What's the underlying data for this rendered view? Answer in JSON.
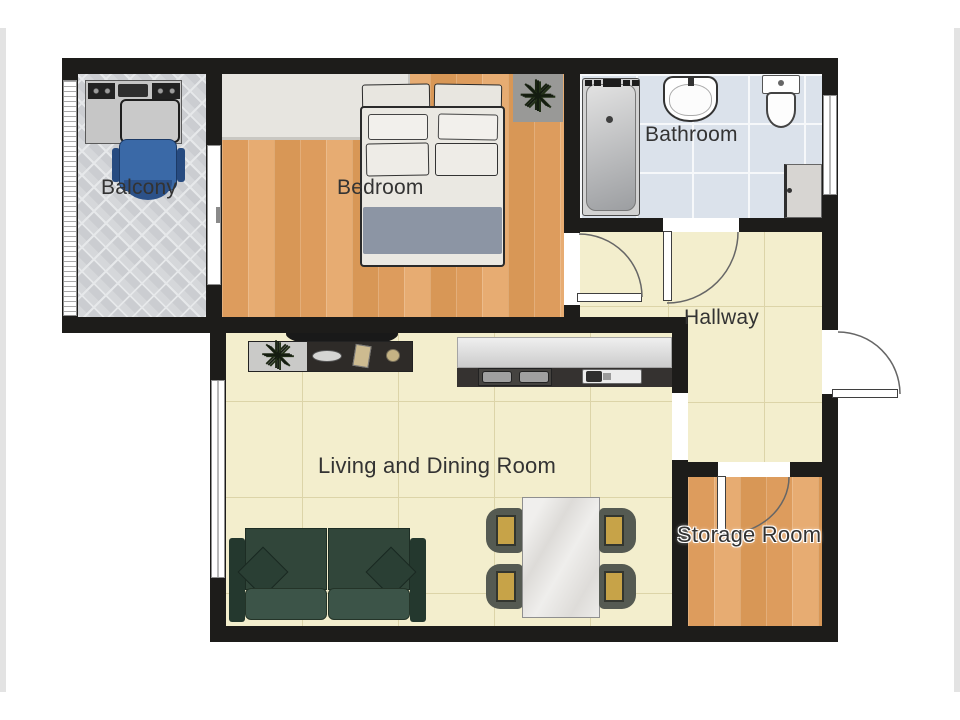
{
  "title": "Apartment Floor Plan",
  "rooms": [
    {
      "id": "balcony",
      "label": "Balcony"
    },
    {
      "id": "bedroom",
      "label": "Bedroom"
    },
    {
      "id": "bathroom",
      "label": "Bathroom"
    },
    {
      "id": "hallway",
      "label": "Hallway"
    },
    {
      "id": "living_dining",
      "label": "Living and Dining Room"
    },
    {
      "id": "storage",
      "label": "Storage Room"
    }
  ],
  "icons": {
    "plant": "✳"
  },
  "colors": {
    "wall": "#1d1c1a",
    "wood_floor": "#e1a469",
    "cream_floor": "#f3eecd",
    "bathroom_tile": "#dbe2eb",
    "balcony_tile": "#d5d7da",
    "sofa": "#31463a",
    "office_chair": "#3a69a7",
    "dining_chair_seat": "#c7a348",
    "bed_blanket": "#8c95a4"
  },
  "furniture": [
    "desk",
    "office-chair",
    "wardrobe",
    "double-bed",
    "plant",
    "bathtub",
    "washbasin",
    "toilet",
    "washing-machine",
    "wall-tv",
    "sideboard",
    "kitchen-counter",
    "stove",
    "kitchen-sink",
    "sofa",
    "dining-table",
    "dining-chairs"
  ],
  "doors": [
    "balcony-sliding-door",
    "bedroom-door",
    "bathroom-door",
    "entrance-door",
    "storage-door"
  ],
  "windows": [
    "balcony-window",
    "living-room-window",
    "bathroom-window"
  ]
}
